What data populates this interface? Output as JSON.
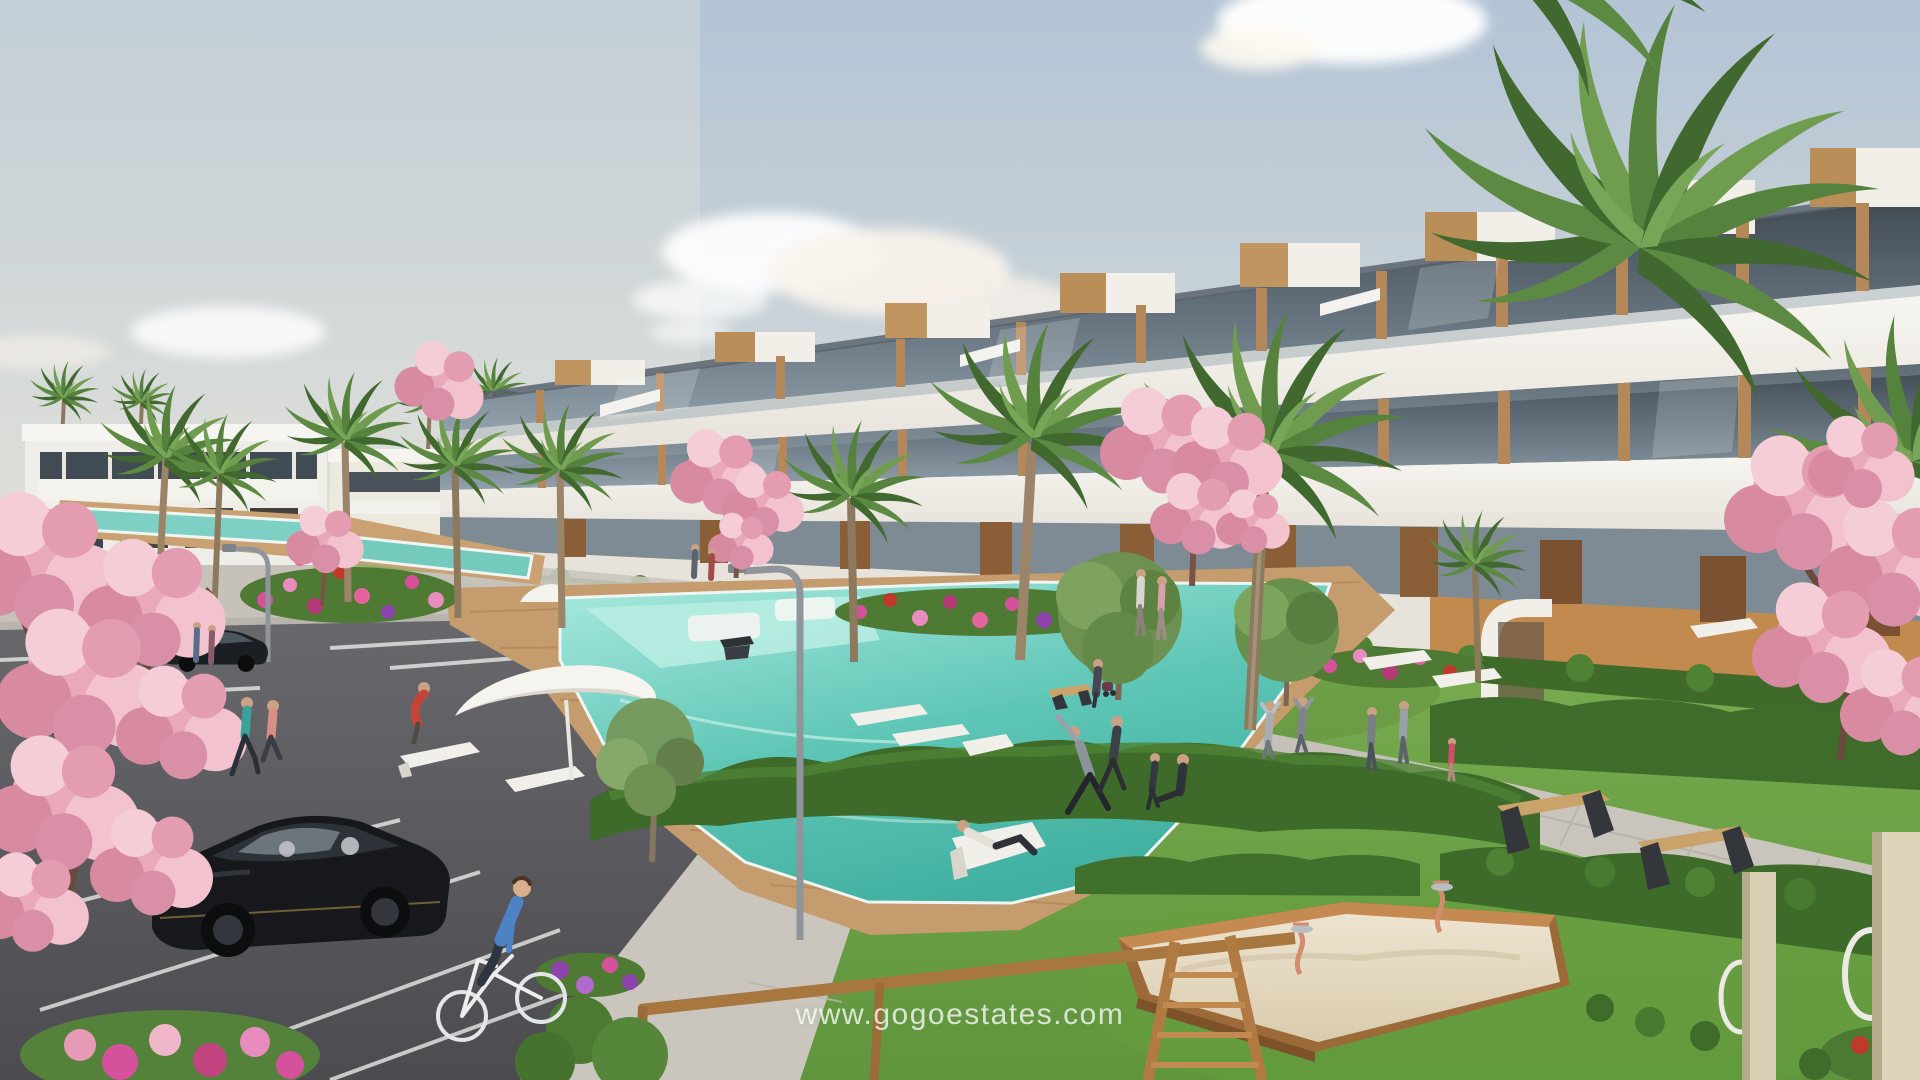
{
  "watermark": {
    "text": "www.gogoestates.com"
  },
  "scene": {
    "type": "photorealistic architectural exterior render",
    "subject": "modern white terraced apartment complex with communal pool garden, parking lot and playground",
    "sky": {
      "clouds": 4
    },
    "buildings": {
      "main": "three-story stepped white apartment block with glass balconies, wood-clad penthouse boxes and wooden panel accents running diagonally to the right",
      "left": "distant two-story white building with dark glazing band beside the parking lot"
    },
    "objects": {
      "pools": 3,
      "palm_trees": 14,
      "blossom_trees": 5,
      "green_trees": 4,
      "cars": 5,
      "bicycle": 1,
      "people": 21,
      "sun_loungers": 9,
      "parasols": 2,
      "benches": 4,
      "street_lamps": 2,
      "sandbox": 1,
      "spring_riders": 2,
      "swing_frame": 1,
      "playground_posts": 2
    },
    "palette": {
      "sky_top": "#b3c4d5",
      "sky_horizon": "#e9e4d8",
      "facade_white": "#f3f1ec",
      "glass_dark": "#4a545e",
      "wood_accent": "#b5885a",
      "lawn_green": "#71a147",
      "hedge_green": "#3e6b2a",
      "pool_turquoise": "#62c8b8",
      "deck_wood": "#c59c6e",
      "asphalt_gray": "#5a5a5e",
      "pavement_gray": "#c9c5bc",
      "blossom_pink": "#eaa9bb",
      "sand_beige": "#e8decb",
      "watermark_white": "#ffffff"
    }
  }
}
